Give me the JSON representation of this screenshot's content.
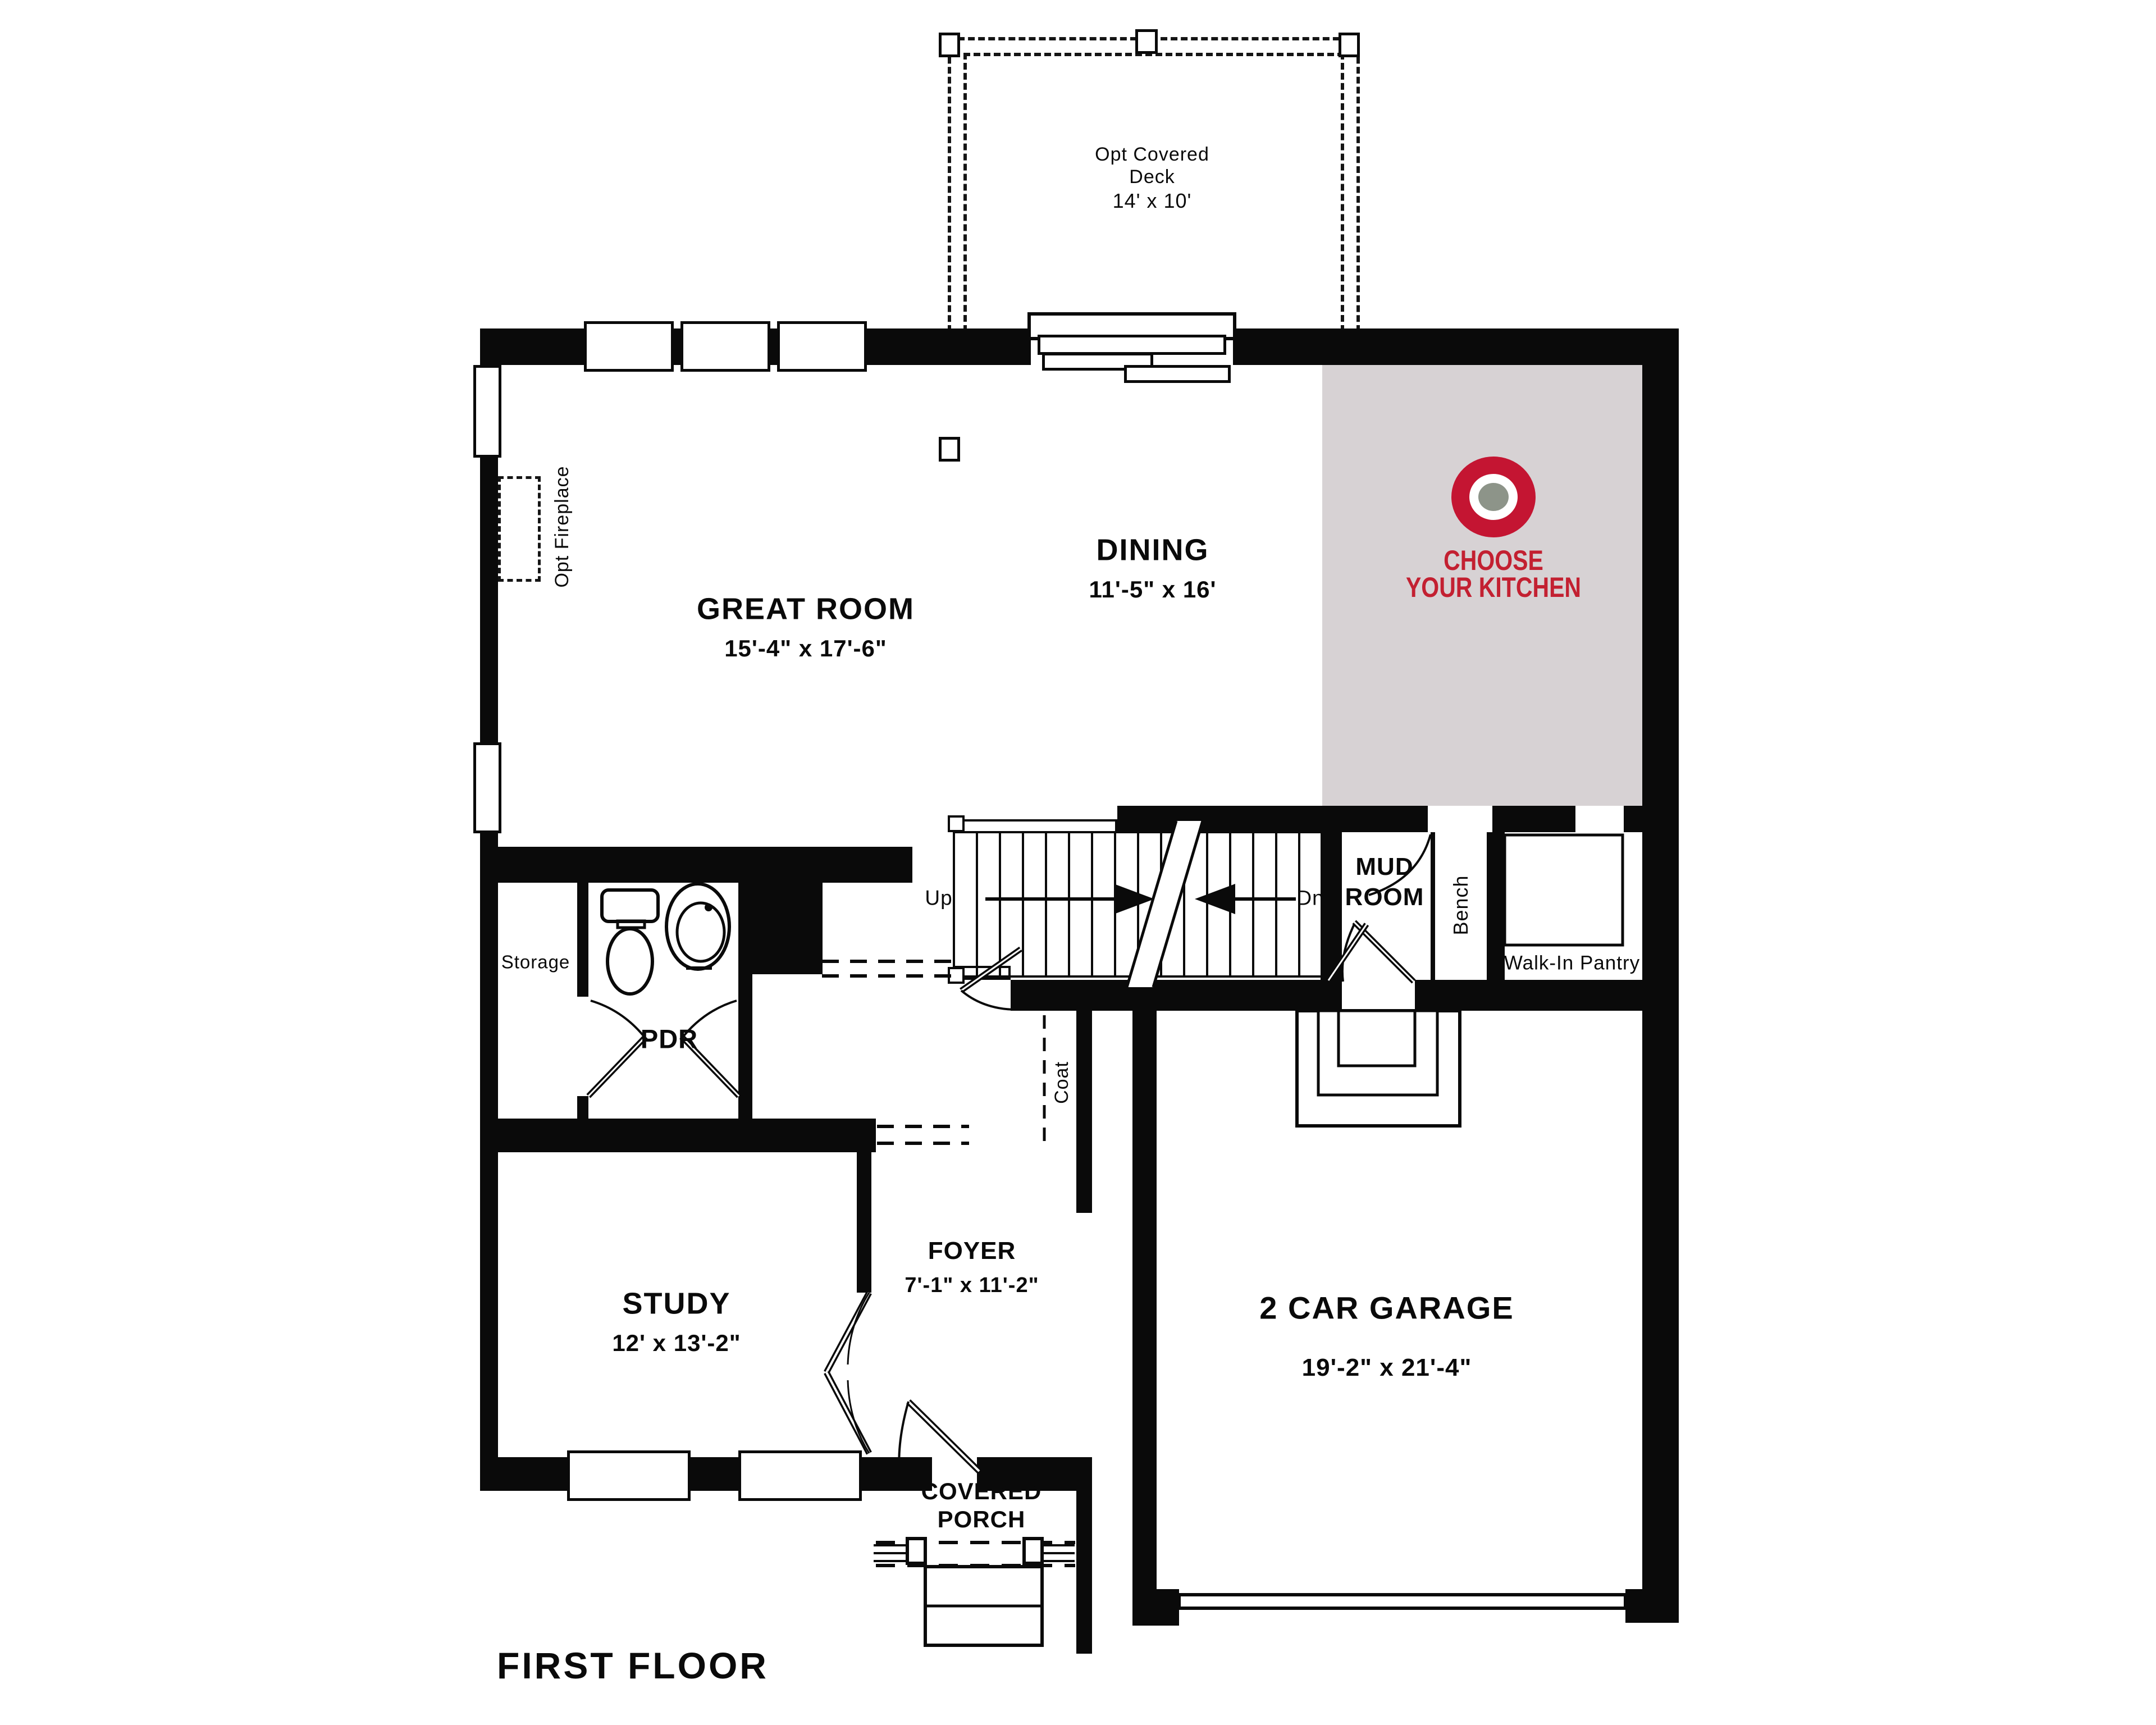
{
  "title": "FIRST FLOOR",
  "colors": {
    "wall": "#0a0a0a",
    "kitchen_area_gray": "#d7d2d4",
    "logo_red": "#c41532",
    "logo_text_red": "#c32031",
    "logo_dot_gray": "#8d9489"
  },
  "rooms": {
    "deck": {
      "line1": "Opt Covered",
      "line2": "Deck",
      "dims": "14' x 10'"
    },
    "great_room": {
      "name": "GREAT ROOM",
      "dims": "15'-4\" x 17'-6\""
    },
    "dining": {
      "name": "DINING",
      "dims": "11'-5\" x 16'"
    },
    "kitchen": {
      "cta_line1": "CHOOSE",
      "cta_line2": "YOUR KITCHEN"
    },
    "mud_room": {
      "line1": "MUD",
      "line2": "ROOM"
    },
    "pantry": {
      "name": "Walk-In Pantry"
    },
    "bench": {
      "name": "Bench"
    },
    "storage": {
      "name": "Storage"
    },
    "pdr": {
      "name": "PDR"
    },
    "coat": {
      "name": "Coat"
    },
    "study": {
      "name": "STUDY",
      "dims": "12' x 13'-2\""
    },
    "foyer": {
      "name": "FOYER",
      "dims": "7'-1\" x 11'-2\""
    },
    "garage": {
      "name": "2 CAR GARAGE",
      "dims": "19'-2\" x 21'-4\""
    },
    "porch": {
      "line1": "COVERED",
      "line2": "PORCH"
    },
    "fireplace": {
      "name": "Opt Fireplace"
    }
  },
  "stairs": {
    "up": "Up",
    "dn": "Dn"
  }
}
